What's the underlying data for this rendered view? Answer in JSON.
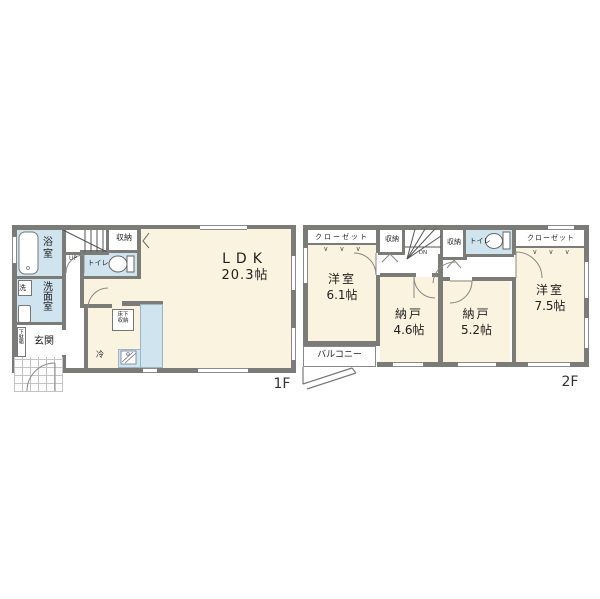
{
  "colors": {
    "wall": "#7b7b78",
    "room": "#faf3e0",
    "water": "#cfe4ee",
    "line": "#8a8a8a",
    "text": "#1f1f1f"
  },
  "f1": {
    "floor_label": "1F",
    "ldk": "LDK",
    "ldk_size": "20.3帖",
    "bath": "浴室",
    "washroom": "洗面室",
    "washer": "洗",
    "entrance": "玄関",
    "shoe_cabinet": "下駄箱",
    "toilet": "トイレ",
    "storage": "収納",
    "underfloor_storage": "床下\n収納",
    "fridge": "冷",
    "stairs": "UP"
  },
  "f2": {
    "floor_label": "2F",
    "bedroom1": "洋室",
    "bedroom1_size": "6.1帖",
    "bedroom2": "洋室",
    "bedroom2_size": "7.5帖",
    "storage_room1": "納戸",
    "storage_room1_size": "4.6帖",
    "storage_room2": "納戸",
    "storage_room2_size": "5.2帖",
    "balcony": "バルコニー",
    "closet_left": "クローゼット",
    "closet_right": "クローゼット",
    "storage_a": "収納",
    "storage_b": "収納",
    "toilet": "トイレ",
    "stairs": "DN",
    "hangers": "∨     ∨     ∨"
  }
}
